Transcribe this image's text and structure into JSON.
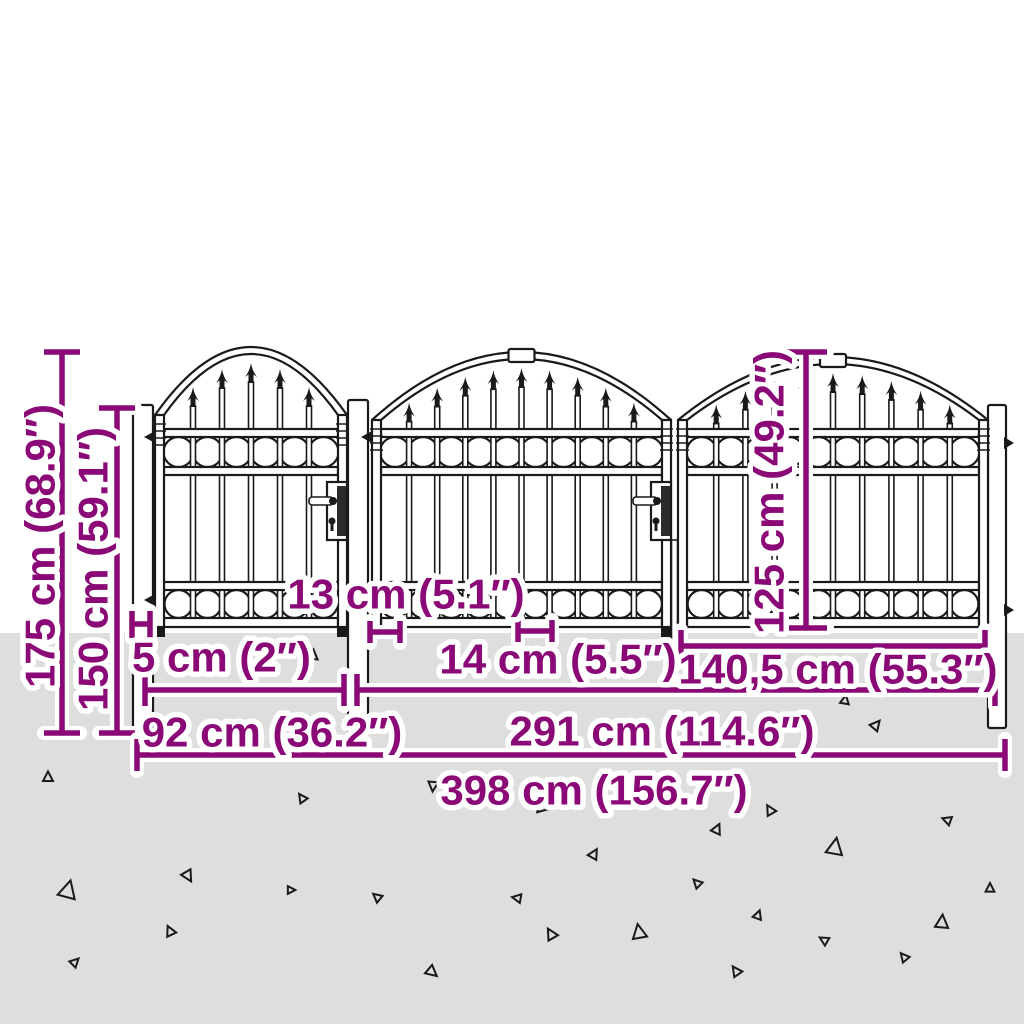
{
  "diagram_type": "garden-gate-dimension-diagram",
  "dims": {
    "total_height": "175 cm (68.9″)",
    "post_height": "150 cm (59.1″)",
    "panel_height": "125 cm (49.2″)",
    "top_gap": "13 cm (5.1″)",
    "post_width": "5 cm (2″)",
    "bar_gap": "14 cm (5.5″)",
    "leaf_width": "140,5 cm (55.3″)",
    "side_gate_width": "92 cm (36.2″)",
    "double_gate_width": "291 cm (114.6″)",
    "total_width": "398 cm (156.7″)"
  },
  "colors": {
    "dimension": "#8B0877",
    "ground": "#DEDEDE",
    "outline": "#1A1A1A",
    "background": "#FFFFFF"
  },
  "icons": {
    "spear_finial": "spear-finial",
    "ring_ornament": "ring-ornament",
    "hinge": "hinge-icon",
    "keyhole": "keyhole-icon",
    "gravel": "gravel-triangle"
  }
}
